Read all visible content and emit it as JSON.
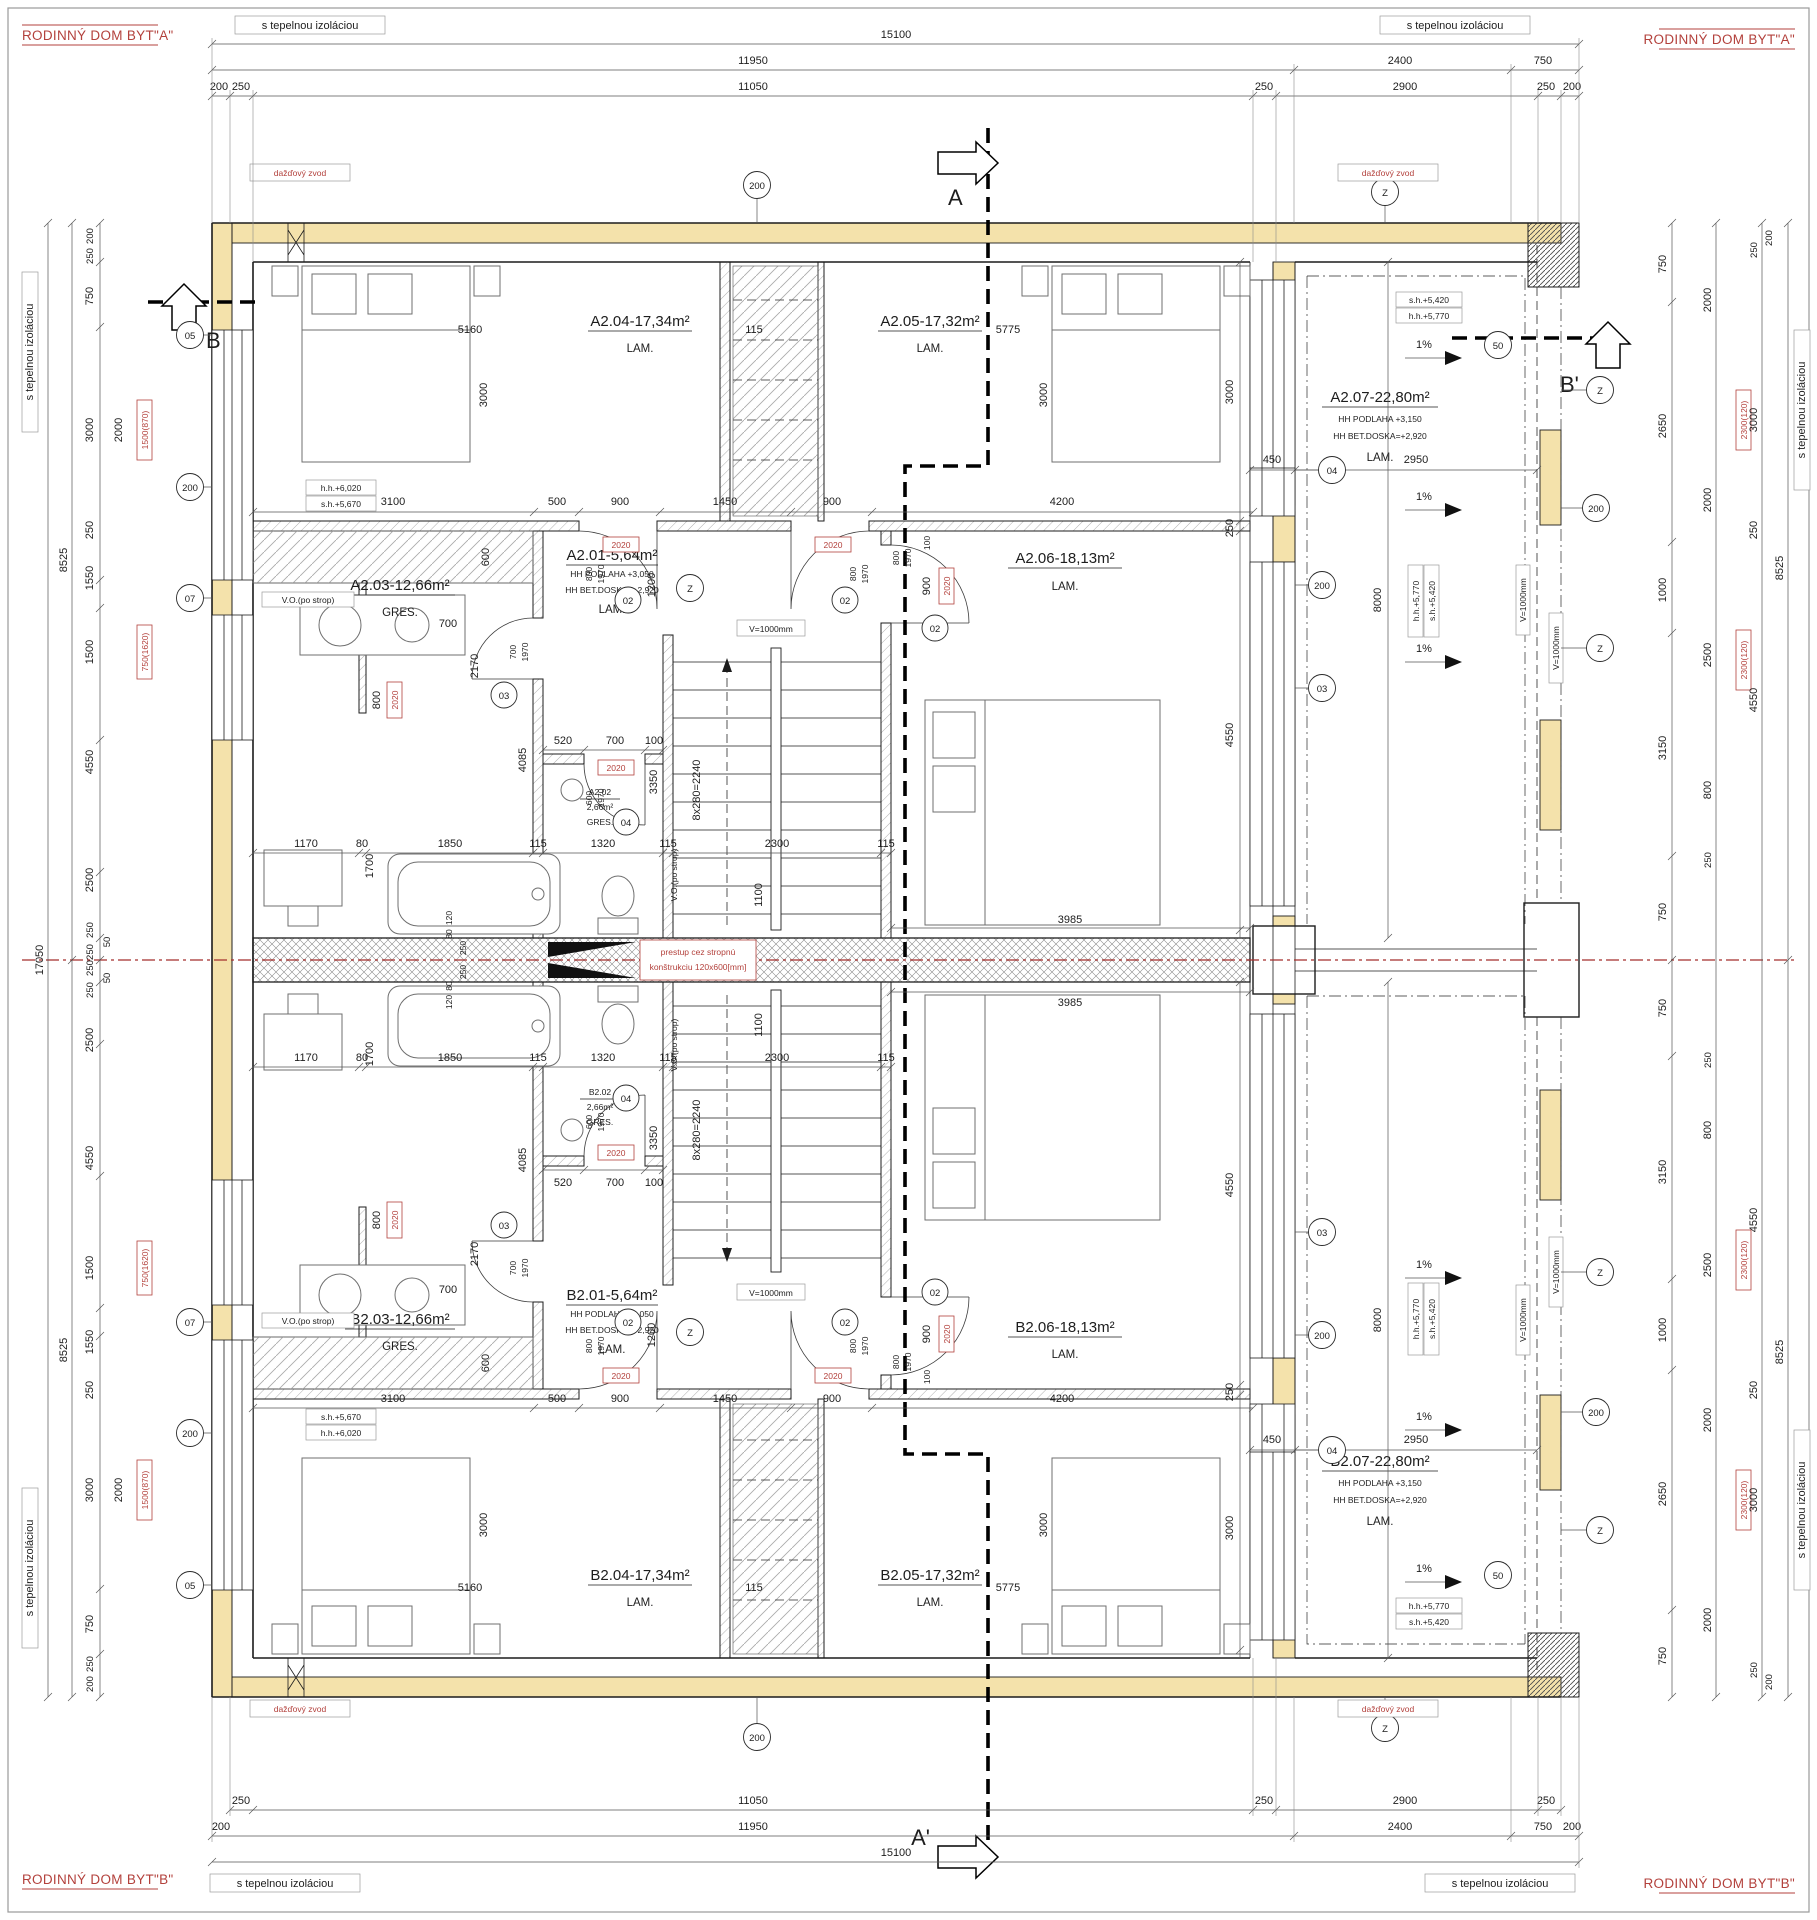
{
  "titles": {
    "byt_a": "RODINNÝ DOM BYT\"A\"",
    "byt_b": "RODINNÝ DOM BYT\"B\""
  },
  "labels": {
    "insulation": "s tepelnou izoláciou",
    "rain_drain": "dažďový zvod",
    "slab_pass_line1": "prestup cez stropnú",
    "slab_pass_line2": "konštrukciu 120x600[mm]",
    "vo_strop": "V.O.(po strop)",
    "v1000": "V=1000mm",
    "slope": "1%",
    "stair_formula": "8x280=2240"
  },
  "sections": {
    "a": "A",
    "a_prime": "A'",
    "b": "B",
    "b_prime": "B'"
  },
  "axes": {
    "a05": "05",
    "a07": "07",
    "a200": "200",
    "a04": "04",
    "a03": "03",
    "a02": "02",
    "a50": "50",
    "az": "Z"
  },
  "levels": {
    "hh6020": "h.h.+6,020",
    "sh5670": "s.h.+5,670",
    "hh5770": "h.h.+5,770",
    "sh5420": "s.h.+5,420"
  },
  "door_code": "2020",
  "leaf": {
    "w800": "800",
    "h1970": "1970",
    "w700": "700",
    "w600": "600"
  },
  "rooms": {
    "a201": {
      "name": "A2.01-5,64m²",
      "floor_note": "HH PODLAHA +3,050",
      "slab_note": "HH BET.DOSKA=+2,920",
      "finish": "LAM."
    },
    "a202": {
      "name": "A2.02",
      "area": "2,66m²",
      "finish": "GRES."
    },
    "a203": {
      "name": "A2.03-12,66m²",
      "finish": "GRES."
    },
    "a204": {
      "name": "A2.04-17,34m²",
      "finish": "LAM."
    },
    "a205": {
      "name": "A2.05-17,32m²",
      "finish": "LAM."
    },
    "a206": {
      "name": "A2.06-18,13m²",
      "finish": "LAM."
    },
    "a207": {
      "name": "A2.07-22,80m²",
      "floor_note": "HH PODLAHA +3,150",
      "slab_note": "HH BET.DOSKA=+2,920",
      "finish": "LAM."
    },
    "b201": {
      "name": "B2.01-5,64m²",
      "floor_note": "HH PODLAHA +3,050",
      "slab_note": "HH BET.DOSKA=+2,920",
      "finish": "LAM."
    },
    "b202": {
      "name": "B2.02",
      "area": "2,66m²",
      "finish": "GRES."
    },
    "b203": {
      "name": "B2.03-12,66m²",
      "finish": "GRES."
    },
    "b204": {
      "name": "B2.04-17,34m²",
      "finish": "LAM."
    },
    "b205": {
      "name": "B2.05-17,32m²",
      "finish": "LAM."
    },
    "b206": {
      "name": "B2.06-18,13m²",
      "finish": "LAM."
    },
    "b207": {
      "name": "B2.07-22,80m²",
      "floor_note": "HH PODLAHA +3,150",
      "slab_note": "HH BET.DOSKA=+2,920",
      "finish": "LAM."
    }
  },
  "dims": {
    "d15100": "15100",
    "d11950": "11950",
    "d11050": "11050",
    "d2400": "2400",
    "d2900": "2900",
    "d750": "750",
    "d250": "250",
    "d200": "200",
    "d17050": "17050",
    "d8525": "8525",
    "d3000": "3000",
    "d2000": "2000",
    "d1550": "1550",
    "d1500": "1500",
    "d4550": "4550",
    "d2500": "2500",
    "d50": "50",
    "d2650": "2650",
    "d1000": "1000",
    "d3150": "3150",
    "d800": "800",
    "d5160": "5160",
    "d115": "115",
    "d5775": "5775",
    "d3100": "3100",
    "d500": "500",
    "d900": "900",
    "d1450": "1450",
    "d4200": "4200",
    "d600": "600",
    "d1200": "1200",
    "d100": "100",
    "d520": "520",
    "d700": "700",
    "d1170": "1170",
    "d80": "80",
    "d120": "120",
    "d1850": "1850",
    "d1320": "1320",
    "d2300": "2300",
    "d3985": "3985",
    "d450": "450",
    "d2950": "2950",
    "d1700": "1700",
    "d4085": "4085",
    "d2170": "2170",
    "d3350": "3350",
    "d1100": "1100",
    "d8000": "8000",
    "red1500": "1500(870)",
    "red750": "750(1620)",
    "red2300": "2300(120)"
  }
}
